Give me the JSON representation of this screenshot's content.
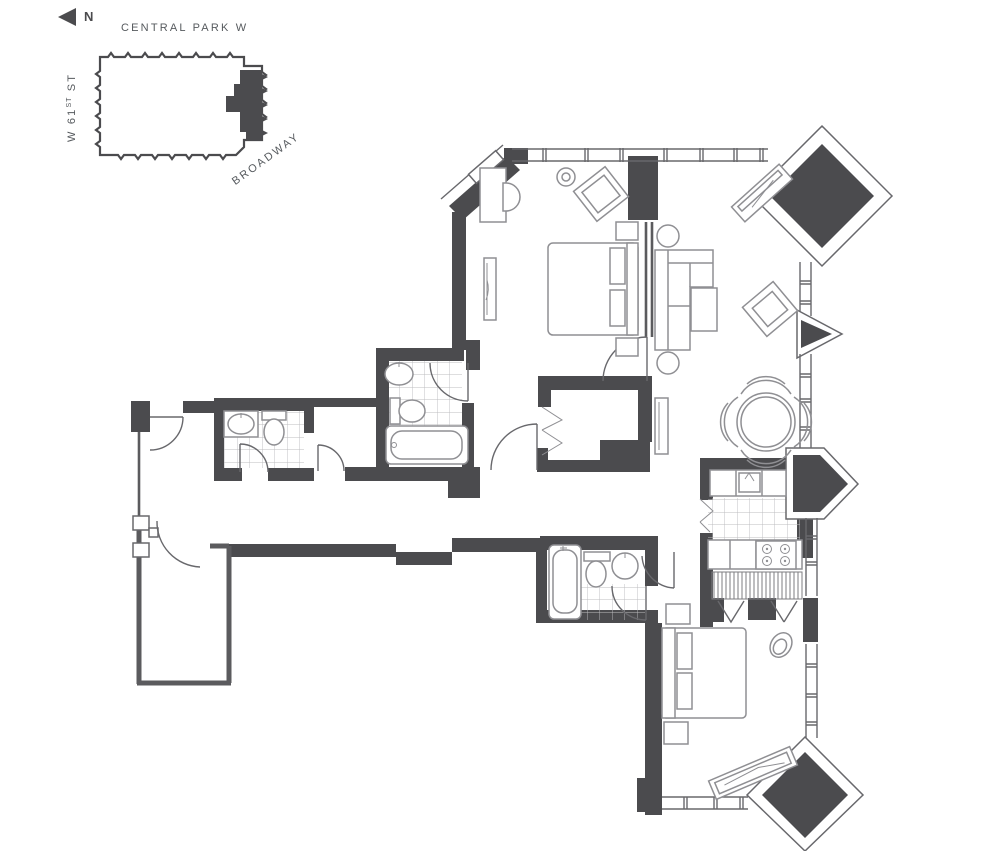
{
  "legend": {
    "north": "N",
    "street_top": "CENTRAL PARK W",
    "street_left_prefix": "W 61",
    "street_left_sup": "ST",
    "street_left_suffix": " ST",
    "street_diagonal": "BROADWAY"
  },
  "colors": {
    "wall": "#4b4b4e",
    "line": "#68686c",
    "furniture": "#8f8f93",
    "tile": "#bcbcbf",
    "text": "#565a5e",
    "background": "#ffffff"
  },
  "icons": {
    "north_arrow": "left-pointing-triangle"
  }
}
